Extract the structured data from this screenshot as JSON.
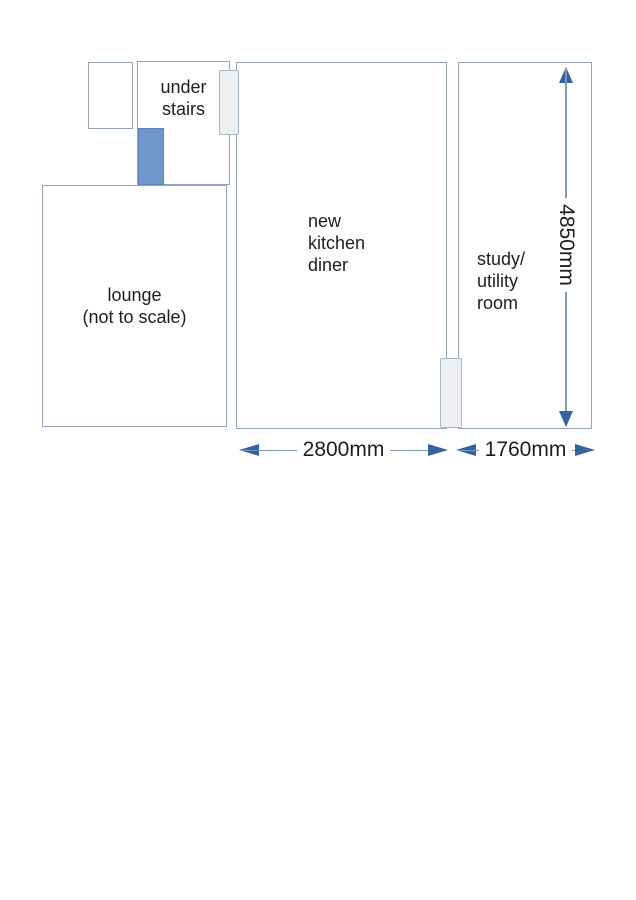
{
  "colors": {
    "wall": "#94a4b8",
    "door_fill": "#edeff2",
    "door_border": "#a8b7c7",
    "stairs_fill": "#7097ca",
    "stairs_border": "#5d85b8",
    "arrow_line": "#7f96bd",
    "arrow_head": "#35639f",
    "text": "#1d1d1f"
  },
  "rooms": {
    "under_stairs": {
      "lines": [
        "under",
        "stairs"
      ]
    },
    "lounge": {
      "lines": [
        "lounge",
        "(not to scale)"
      ]
    },
    "kitchen_diner": {
      "lines": [
        "new",
        "kitchen",
        "diner"
      ]
    },
    "study_utility": {
      "lines": [
        "study/",
        "utility",
        "room"
      ]
    }
  },
  "dimensions": {
    "kitchen_width": "2800mm",
    "study_width": "1760mm",
    "height": "4850mm"
  }
}
